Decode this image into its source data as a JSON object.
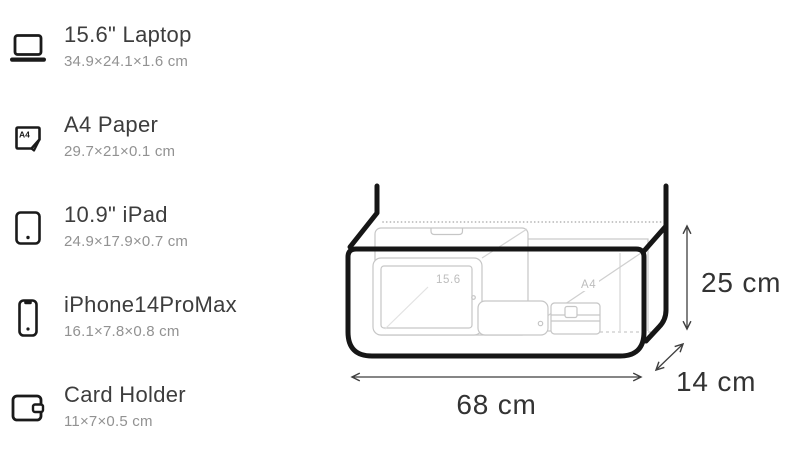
{
  "sidebar": {
    "items": [
      {
        "title": "15.6\" Laptop",
        "dims": "34.9×24.1×1.6 cm"
      },
      {
        "title": "A4 Paper",
        "dims": "29.7×21×0.1 cm",
        "icon_badge": "A4"
      },
      {
        "title": "10.9\" iPad",
        "dims": "24.9×17.9×0.7 cm"
      },
      {
        "title": "iPhone14ProMax",
        "dims": "16.1×7.8×0.8 cm"
      },
      {
        "title": "Card Holder",
        "dims": "11×7×0.5 cm"
      }
    ]
  },
  "diagram": {
    "item_labels": {
      "laptop": "15.6",
      "a4_paper": "A4"
    },
    "dimensions": {
      "width_label": "68 cm",
      "height_label": "25 cm",
      "depth_label": "14 cm"
    },
    "colors": {
      "bag_outline": "#161616",
      "item_outline": "#c6c6c6",
      "faint_line": "#dcdcdc",
      "zipper_dots": "#b8b8b8",
      "dimension_lines": "#3f3f3f",
      "dimension_text": "#333333",
      "item_label_text": "#bdbdbd"
    }
  }
}
